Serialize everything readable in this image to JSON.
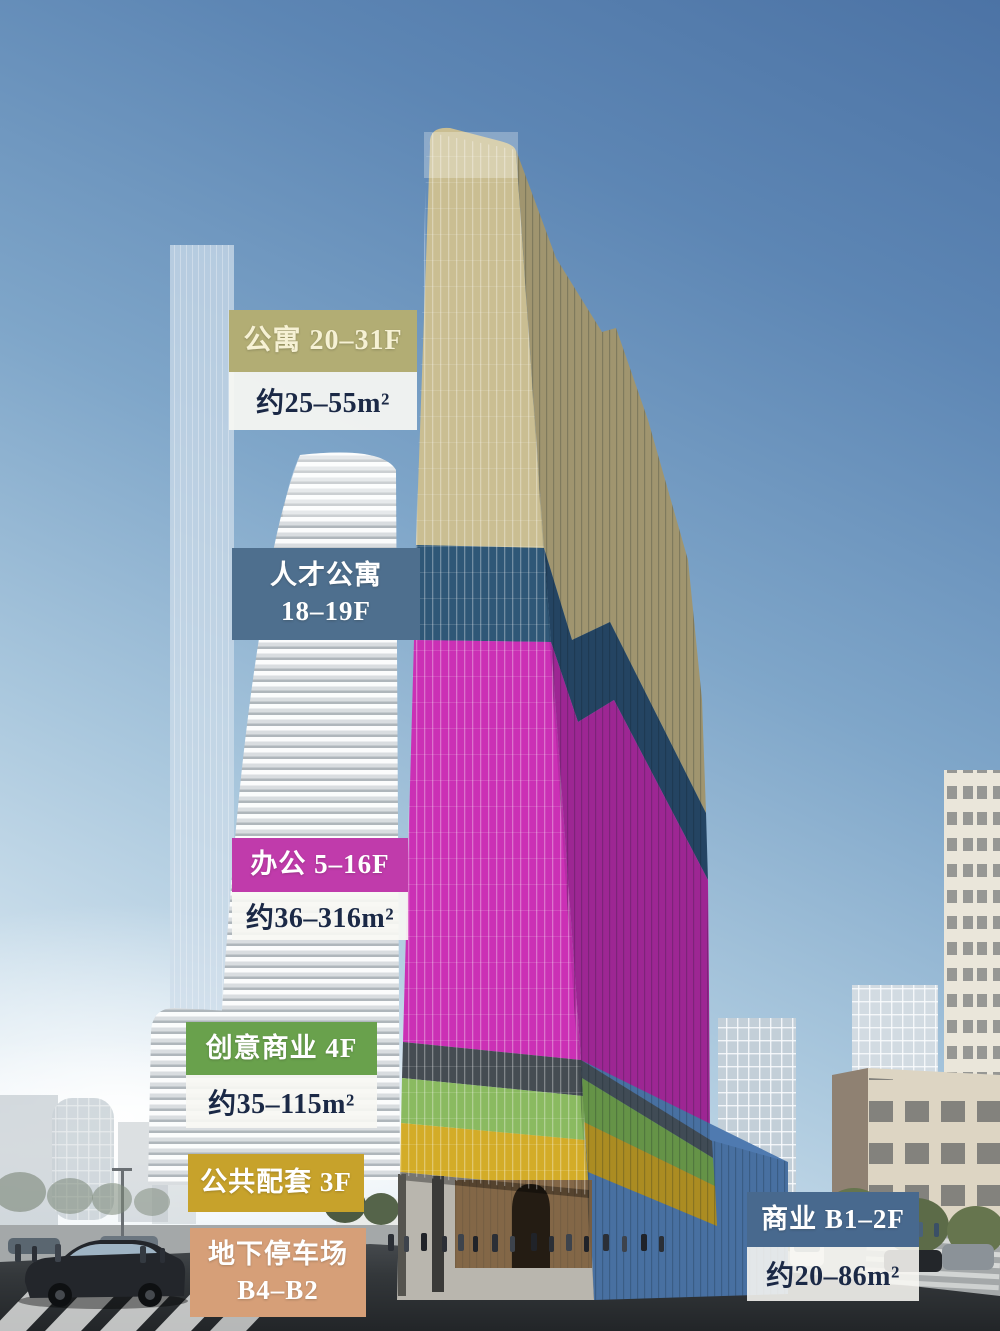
{
  "labels": {
    "apartment": {
      "title": "公寓 20–31F",
      "area": "约25–55m²"
    },
    "talent_apartment": {
      "line1": "人才公寓",
      "line2": "18–19F"
    },
    "office": {
      "title": "办公 5–16F",
      "area": "约36–316m²"
    },
    "creative_retail": {
      "title": "创意商业 4F",
      "area": "约35–115m²"
    },
    "public_amenities": {
      "title": "公共配套 3F"
    },
    "underground_parking": {
      "line1": "地下停车场",
      "line2": "B4–B2"
    },
    "retail": {
      "title": "商业 B1–2F",
      "area": "约20–86m²"
    }
  },
  "colors": {
    "apartment_chip": "#b2ad74",
    "talent_chip": "#4e6f8e",
    "office_chip": "#c03bab",
    "creative_chip": "#69a14c",
    "amenities_chip": "#c7a22b",
    "parking_chip": "#d69f78",
    "retail_chip": "#48698e",
    "facade_gold": "#cabe92",
    "facade_gold_shade": "#b1a478",
    "facade_blue_band": "#2f5777",
    "facade_blue_band_shade": "#27496a",
    "facade_magenta": "#cb30b5",
    "facade_magenta_shade": "#ae28a0",
    "facade_glass_row": "#454c52",
    "facade_green": "#8aba60",
    "facade_green_shade": "#6fa14c",
    "facade_yellow": "#d3ac28",
    "facade_yellow_shade": "#bd9a22",
    "facade_base_blue": "#4f7ab0"
  }
}
